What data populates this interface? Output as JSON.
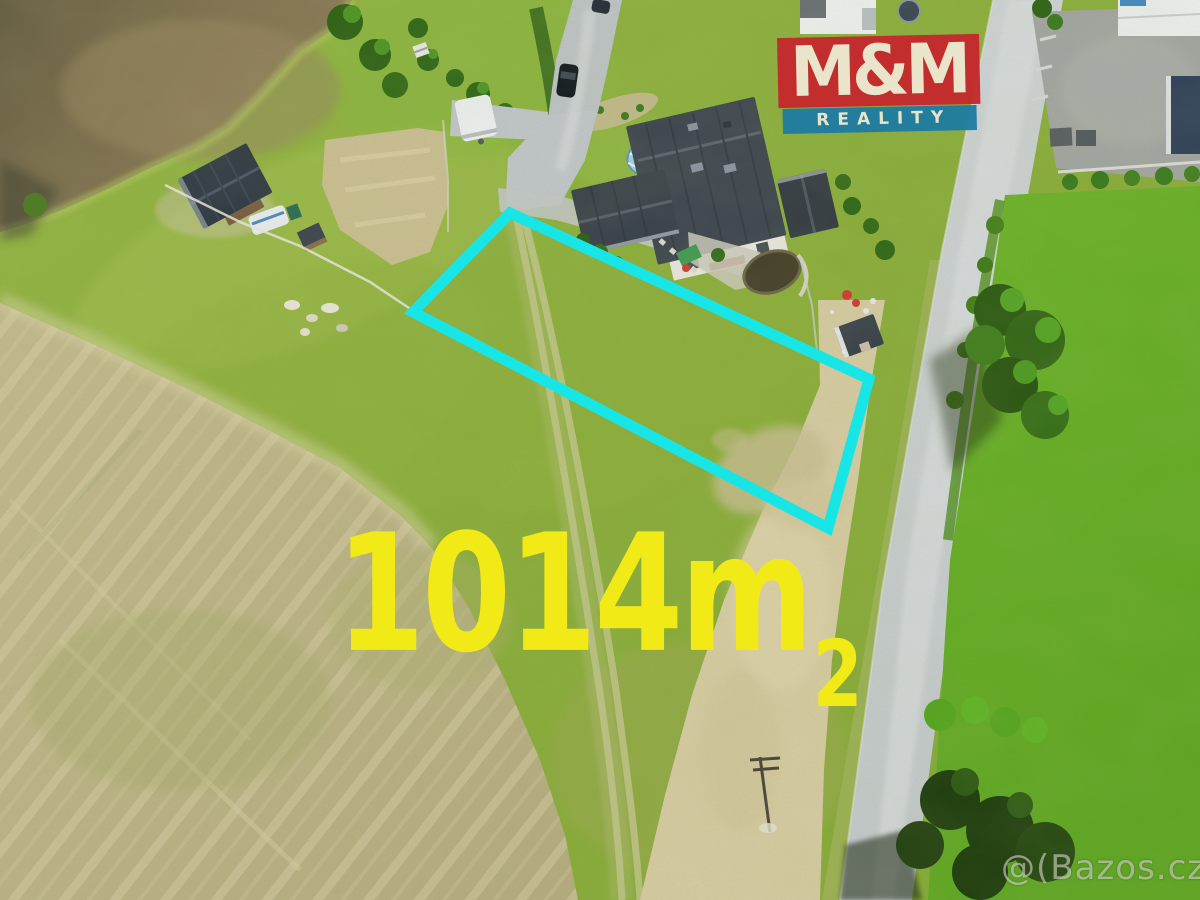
{
  "logo": {
    "top": "M&M",
    "bottom": "REALITY",
    "red_color": "#c5272e",
    "blue_color": "#1e7ca3",
    "text_color": "#efe8d2"
  },
  "area_label": {
    "value": "1014m",
    "superscript": "2",
    "color": "#f2ea16"
  },
  "watermark": {
    "text": "@(Bazos.cz"
  },
  "plot": {
    "outline_color": "#17e5e6"
  }
}
